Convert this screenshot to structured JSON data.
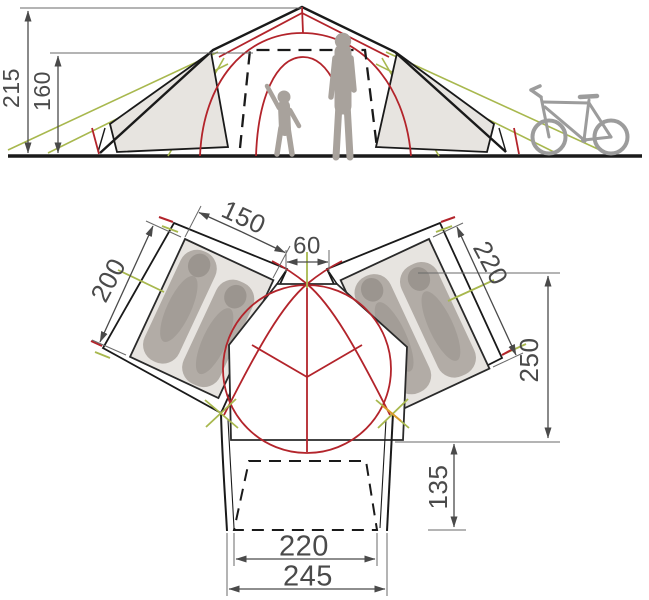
{
  "diagram": {
    "kind": "tent-specification-drawing",
    "side_view": {
      "dims": {
        "peak_height": "215",
        "standing_height": "160"
      },
      "figures": [
        "adult",
        "child",
        "bicycle"
      ]
    },
    "floor_plan": {
      "dims": {
        "left_cabin_width": "150",
        "center_gap": "60",
        "right_cabin_length": "220",
        "left_cabin_length": "200",
        "living_area_depth": "250",
        "porch_depth": "135",
        "porch_inner_width": "220",
        "porch_outer_width": "245"
      }
    },
    "colors": {
      "outline_black": "#1a1a1a",
      "pole_red": "#b3242b",
      "guyline_green": "#a8b84e",
      "peg_orange": "#d99a2b",
      "dimension_gray": "#4a4a4a",
      "fabric_gray": "#e7e4e0",
      "figure_gray": "#a8a29c"
    }
  }
}
